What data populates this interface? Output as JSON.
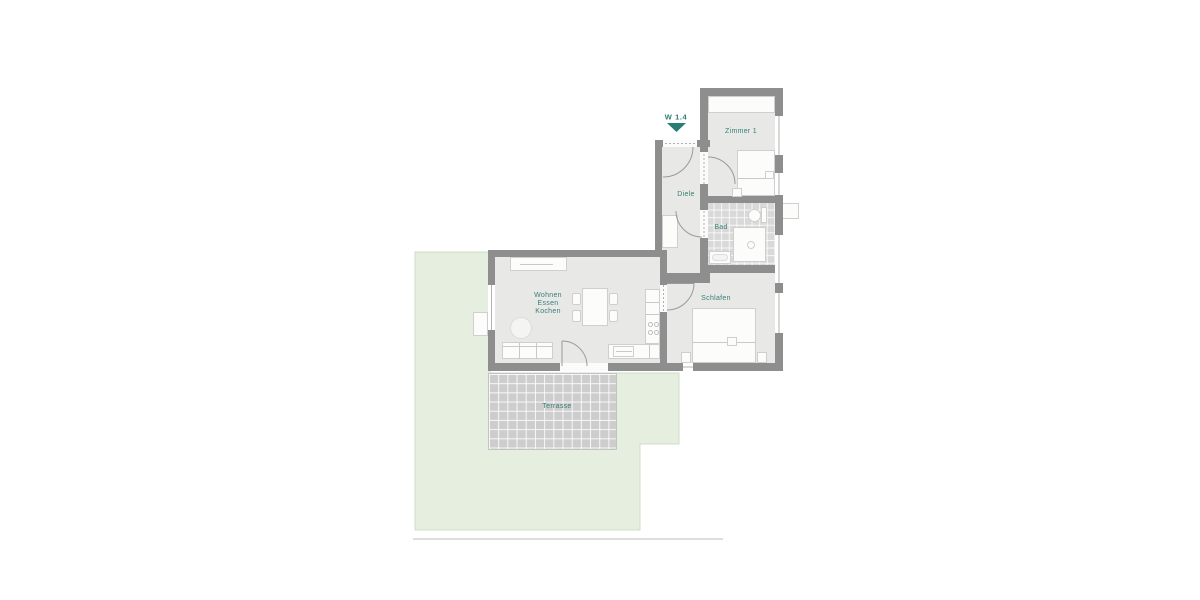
{
  "floor_plan": {
    "unit": {
      "label": "W 1.4"
    },
    "rooms": {
      "zimmer1": {
        "label": "Zimmer 1"
      },
      "diele": {
        "label": "Diele"
      },
      "bad": {
        "label": "Bad"
      },
      "schlafen": {
        "label": "Schlafen"
      },
      "wohnen": {
        "line1": "Wohnen",
        "line2": "Essen",
        "line3": "Kochen"
      },
      "terrasse": {
        "label": "Terrasse"
      }
    },
    "colors": {
      "label_teal": "#377f76",
      "marker_teal": "#2a7d72",
      "wall_gray": "#8e8e8e",
      "floor_gray": "#e8e8e7",
      "garden_green": "#e6eee0",
      "terrace_tile_gray": "#cdcdcd"
    }
  }
}
